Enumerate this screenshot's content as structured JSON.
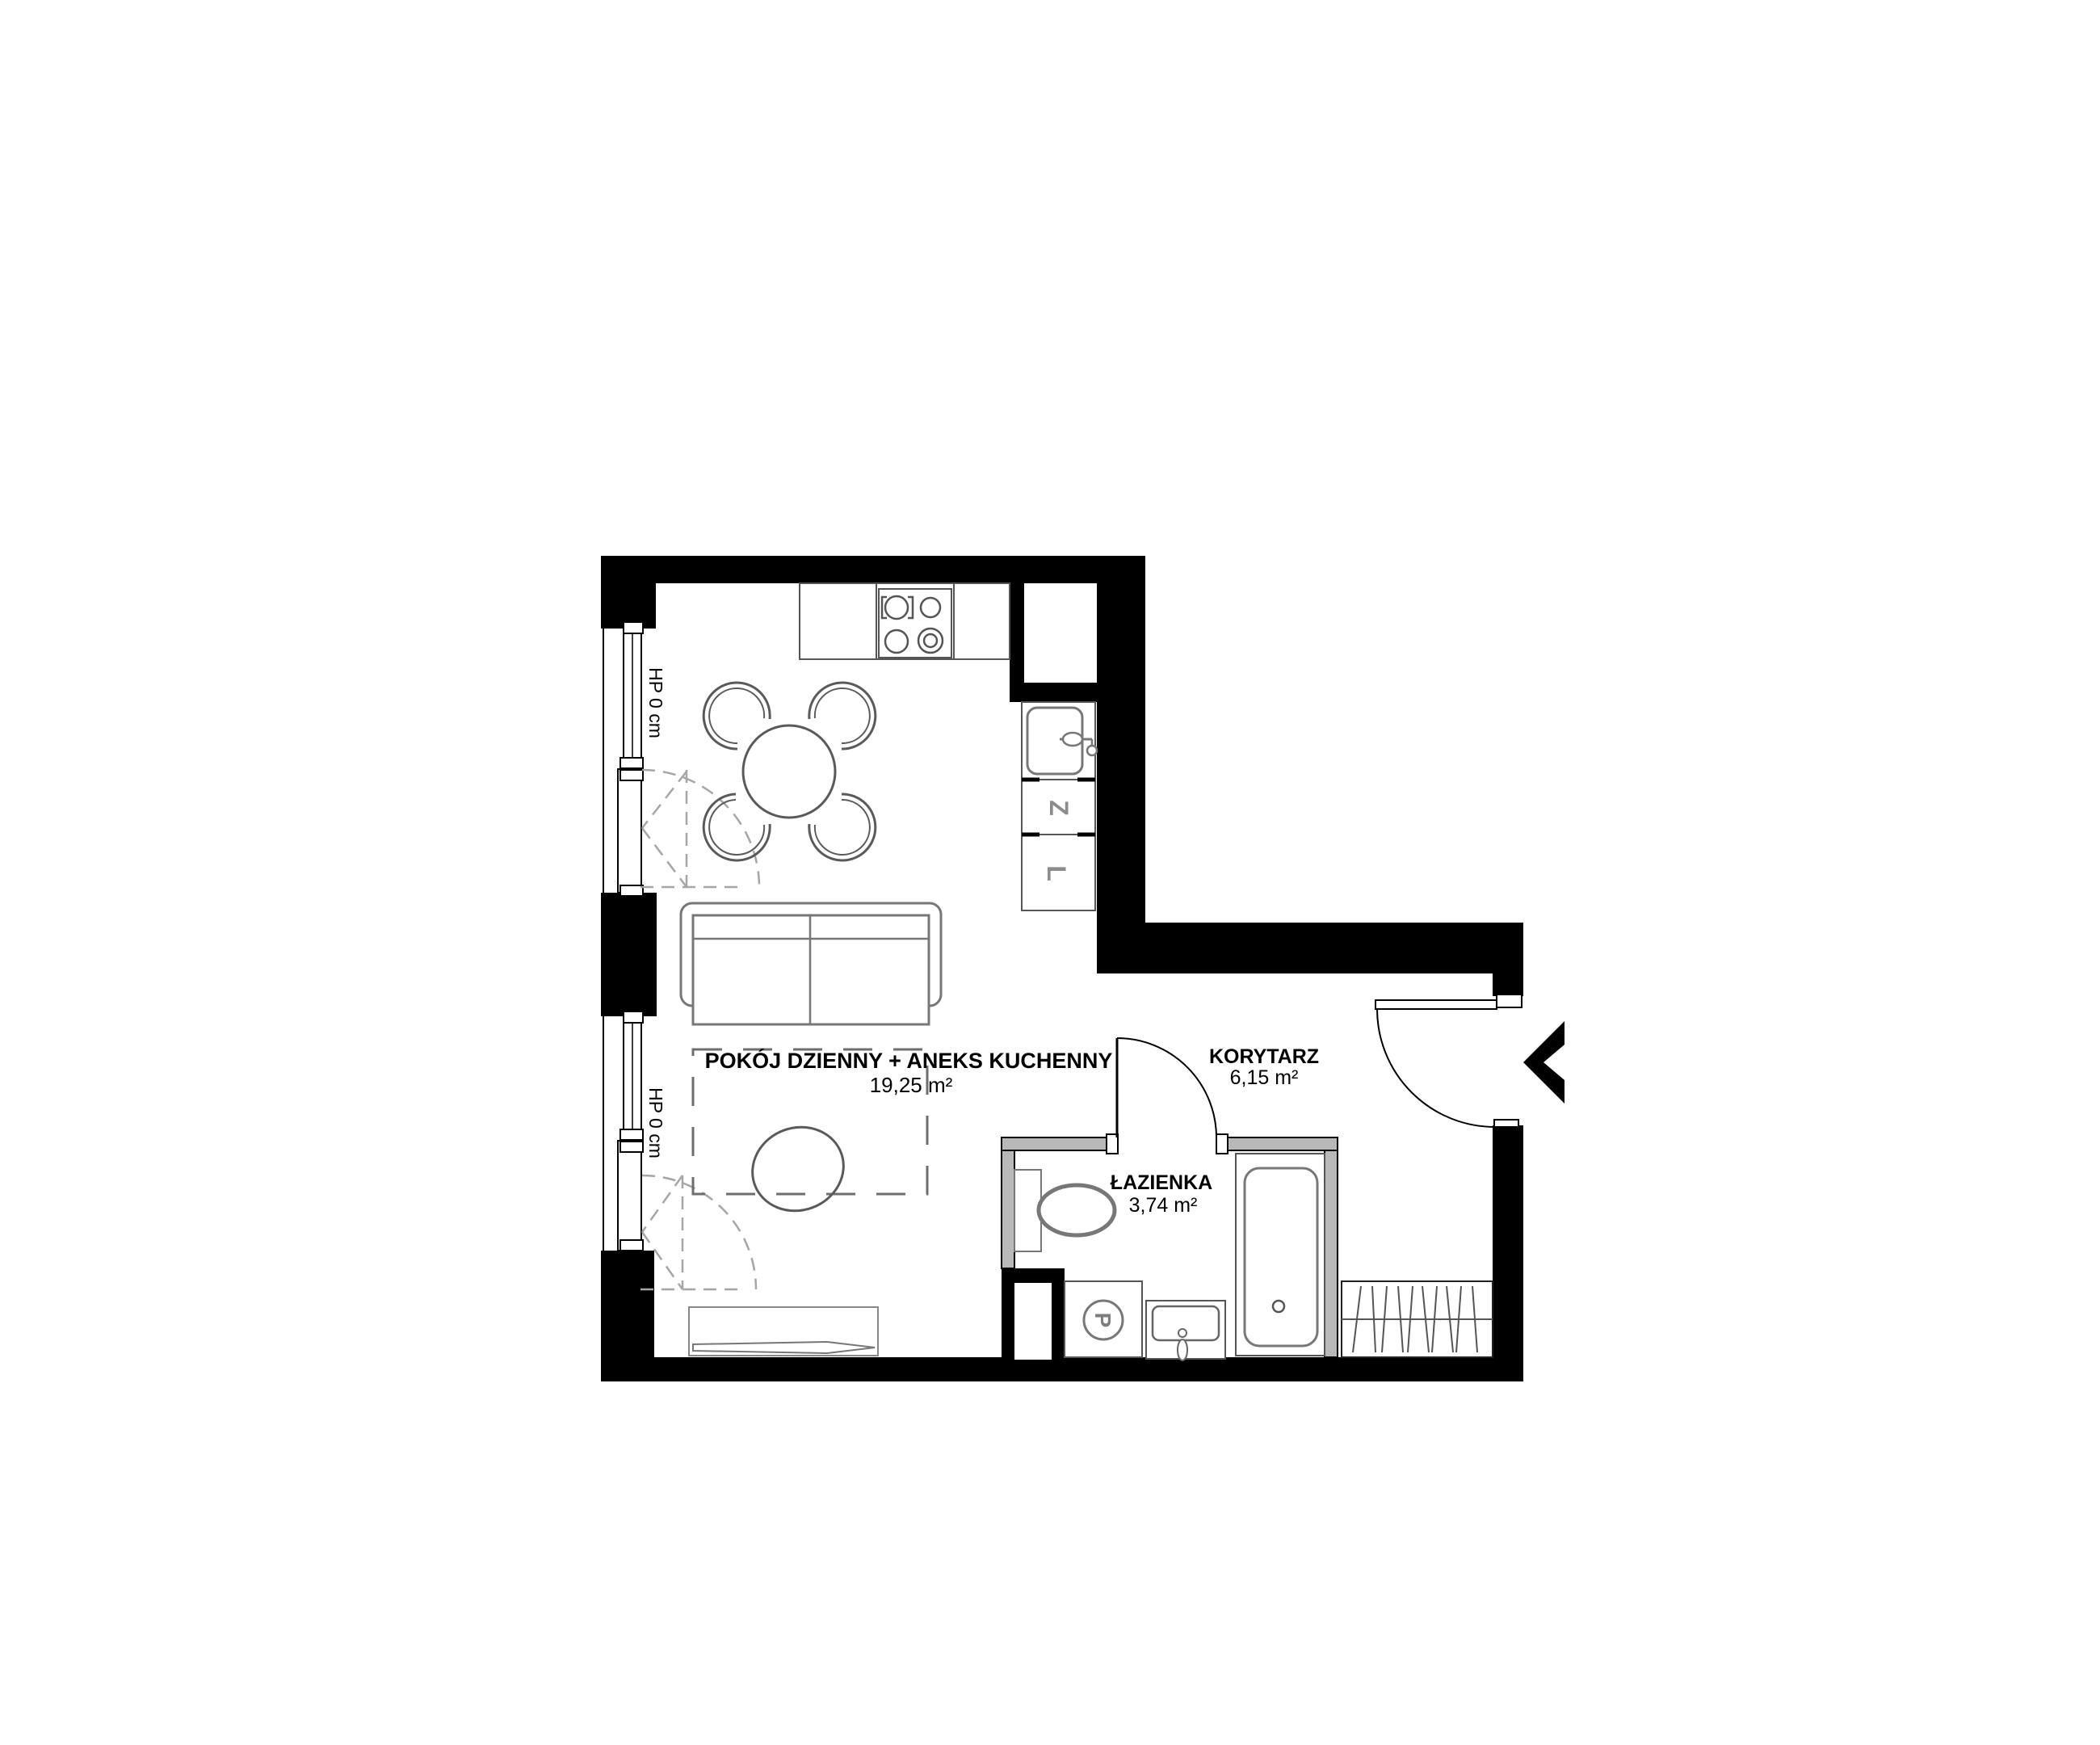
{
  "plan": {
    "rooms": [
      {
        "name": "POKÓJ DZIENNY + ANEKS KUCHENNY",
        "area": "19,25 m²"
      },
      {
        "name": "KORYTARZ",
        "area": "6,15 m²"
      },
      {
        "name": "ŁAZIENKA",
        "area": "3,74 m²"
      }
    ],
    "window_labels": [
      {
        "label": "HP 0 cm"
      },
      {
        "label": "HP 0 cm"
      }
    ],
    "appliances": {
      "dishwasher": "Z",
      "fridge": "L",
      "washer": "P"
    },
    "colors": {
      "wall": "#000000",
      "partition": "#b9b9b9",
      "furniture": "#777777",
      "dashed": "#a6a6a6"
    }
  }
}
